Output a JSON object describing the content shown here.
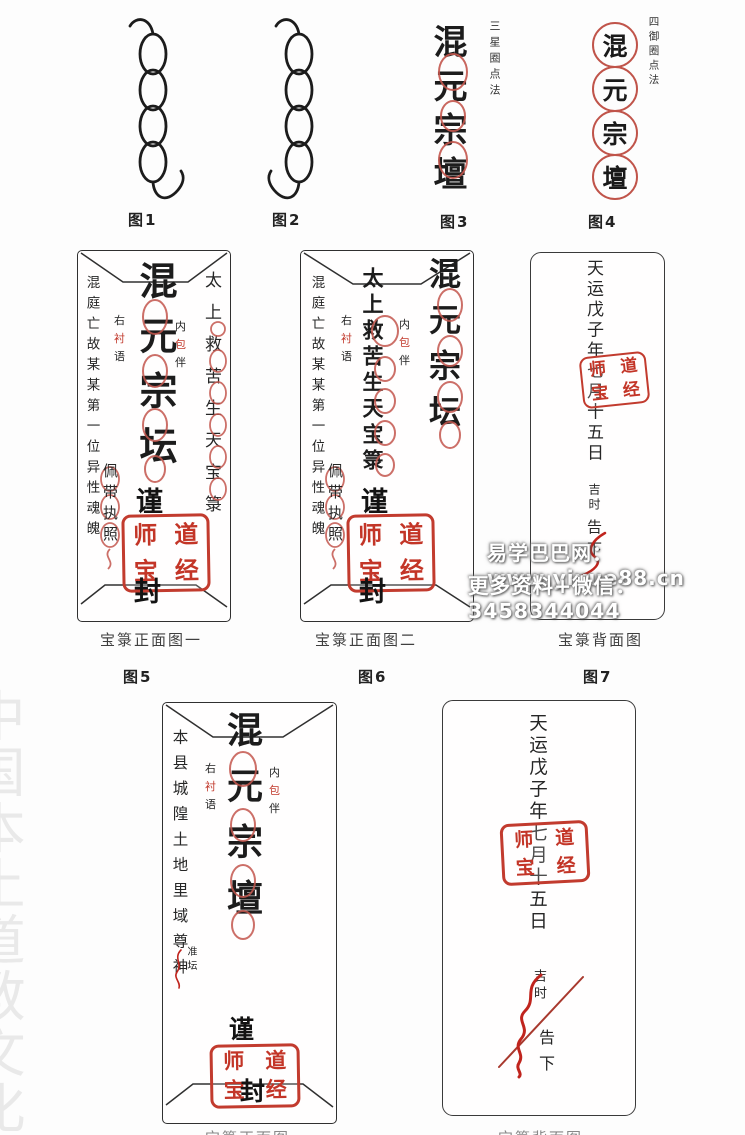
{
  "colors": {
    "ink": "#1c1c1c",
    "seal_red": "#c23b2e",
    "flourish_red": "#c0241d",
    "side_watermark_grey": "#e9e9e9"
  },
  "figures": {
    "fig1": {
      "label": "图1"
    },
    "fig2": {
      "label": "图2"
    },
    "fig3": {
      "label": "图3",
      "text": "混元宗壇",
      "annotation": "三星圈点法"
    },
    "fig4": {
      "label": "图4",
      "annotation": "四御圈点法",
      "chars": {
        "c1": "混",
        "c2": "元",
        "c3": "宗",
        "c4": "壇"
      }
    },
    "fig5": {
      "label": "图5",
      "caption": "宝箓正面图一",
      "center": "混元宗坛",
      "right_column": "太上救苦生天宝箓"
    },
    "fig6": {
      "label": "图6",
      "caption": "宝箓正面图二",
      "center": "太上救苦生天宝箓",
      "right_column": "混元宗坛"
    },
    "fig7": {
      "label": "图7",
      "caption": "宝箓背面图"
    },
    "fig8": {
      "center": "混元宗壇",
      "left_column": "本县城隍土地里域尊神",
      "left_small": "准坛",
      "caption_partial": "宝箓正面图"
    },
    "fig9": {
      "caption_partial": "宝箓背面图"
    }
  },
  "shared": {
    "seal": {
      "tl": "师",
      "tr": "道",
      "bl": "宝",
      "br": "经"
    },
    "close_top": "谨",
    "close_bottom": "封",
    "note_inner": {
      "top": "内",
      "mid": "包",
      "bottom": "伴"
    },
    "note_side": {
      "top": "右",
      "mid": "衬",
      "bottom": "语"
    },
    "wear_note": "佩带执照",
    "deceased_column": "混庭亡故某某第一位异性魂魄",
    "date_column": "天运戊子年七月十五日",
    "time_small": "吉时",
    "notice": "告下"
  },
  "watermark": {
    "line1": "易学巴巴网：www.yixue88.cn",
    "line2": "更多资料+微信：3458344044",
    "side": "中国本土道教文化"
  }
}
